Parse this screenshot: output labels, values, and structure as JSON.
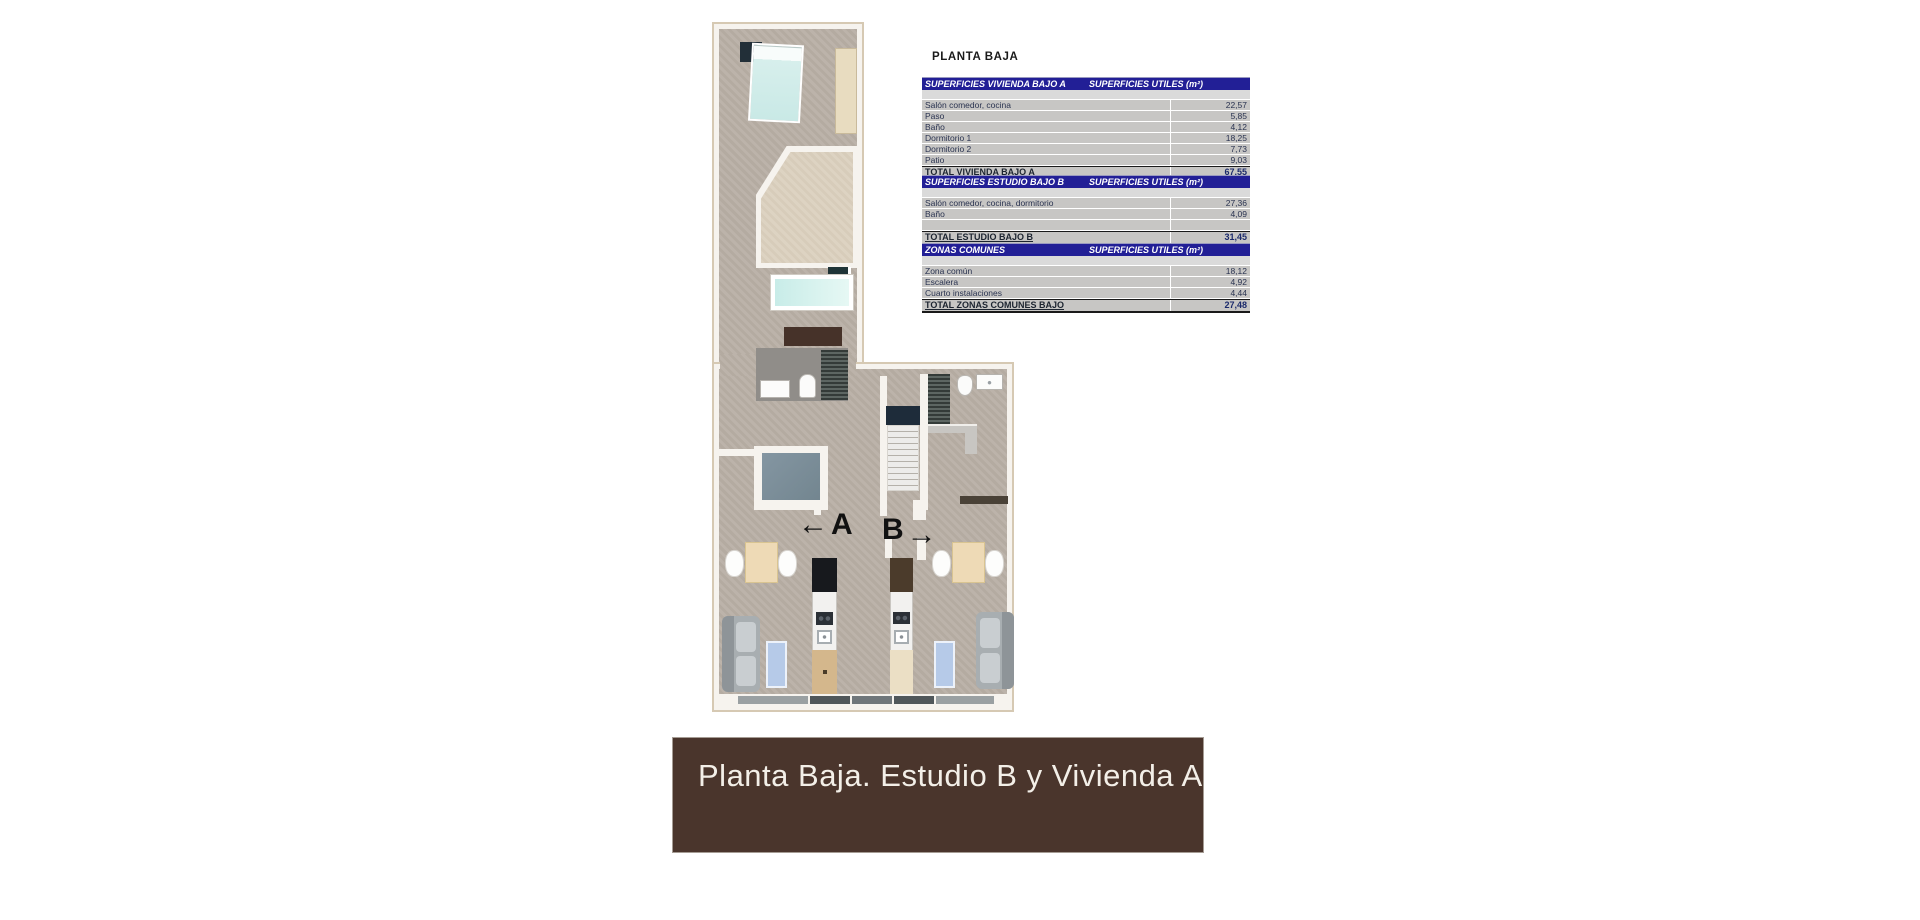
{
  "title": "PLANTA BAJA",
  "plan": {
    "label_a": "A",
    "label_b": "B",
    "arrow_left": "←",
    "arrow_right": "→"
  },
  "tables": [
    {
      "header_left": "SUPERFICIES VIVIENDA BAJO A",
      "header_right": "SUPERFICIES UTILES  (m²)",
      "rows": [
        [
          "Salón comedor, cocina",
          "22,57"
        ],
        [
          "Paso",
          "5,85"
        ],
        [
          "Baño",
          "4,12"
        ],
        [
          "Dormitorio 1",
          "18,25"
        ],
        [
          "Dormitorio 2",
          "7,73"
        ],
        [
          "Patio",
          "9,03"
        ]
      ],
      "total_label": "TOTAL VIVIENDA BAJO A",
      "total_value": "67,55"
    },
    {
      "header_left": "SUPERFICIES ESTUDIO BAJO B",
      "header_right": "SUPERFICIES UTILES  (m²)",
      "rows": [
        [
          "Salón comedor, cocina, dormitorio",
          "27,36"
        ],
        [
          "Baño",
          "4,09"
        ],
        [
          "",
          ""
        ]
      ],
      "total_label": "TOTAL ESTUDIO BAJO B",
      "total_value": "31,45"
    },
    {
      "header_left": "ZONAS COMUNES",
      "header_right": "SUPERFICIES UTILES  (m²)",
      "rows": [
        [
          "Zona común",
          "18,12"
        ],
        [
          "Escalera",
          "4,92"
        ],
        [
          "Cuarto instalaciones",
          "4,44"
        ]
      ],
      "total_label": "TOTAL ZONAS COMUNES BAJO",
      "total_value": "27,48"
    }
  ],
  "banner": {
    "text": "Planta Baja. Estudio B y Vivienda A"
  },
  "colors": {
    "table_header_bg": "#221f96",
    "table_row_bg": "#c7c6c4",
    "banner_bg": "#4a352c",
    "banner_fg": "#f3efe8",
    "floor": "#b8afa5",
    "wall": "#f6f3ee",
    "pool_water": "#cdeeea",
    "rug": "#b6cae8"
  }
}
